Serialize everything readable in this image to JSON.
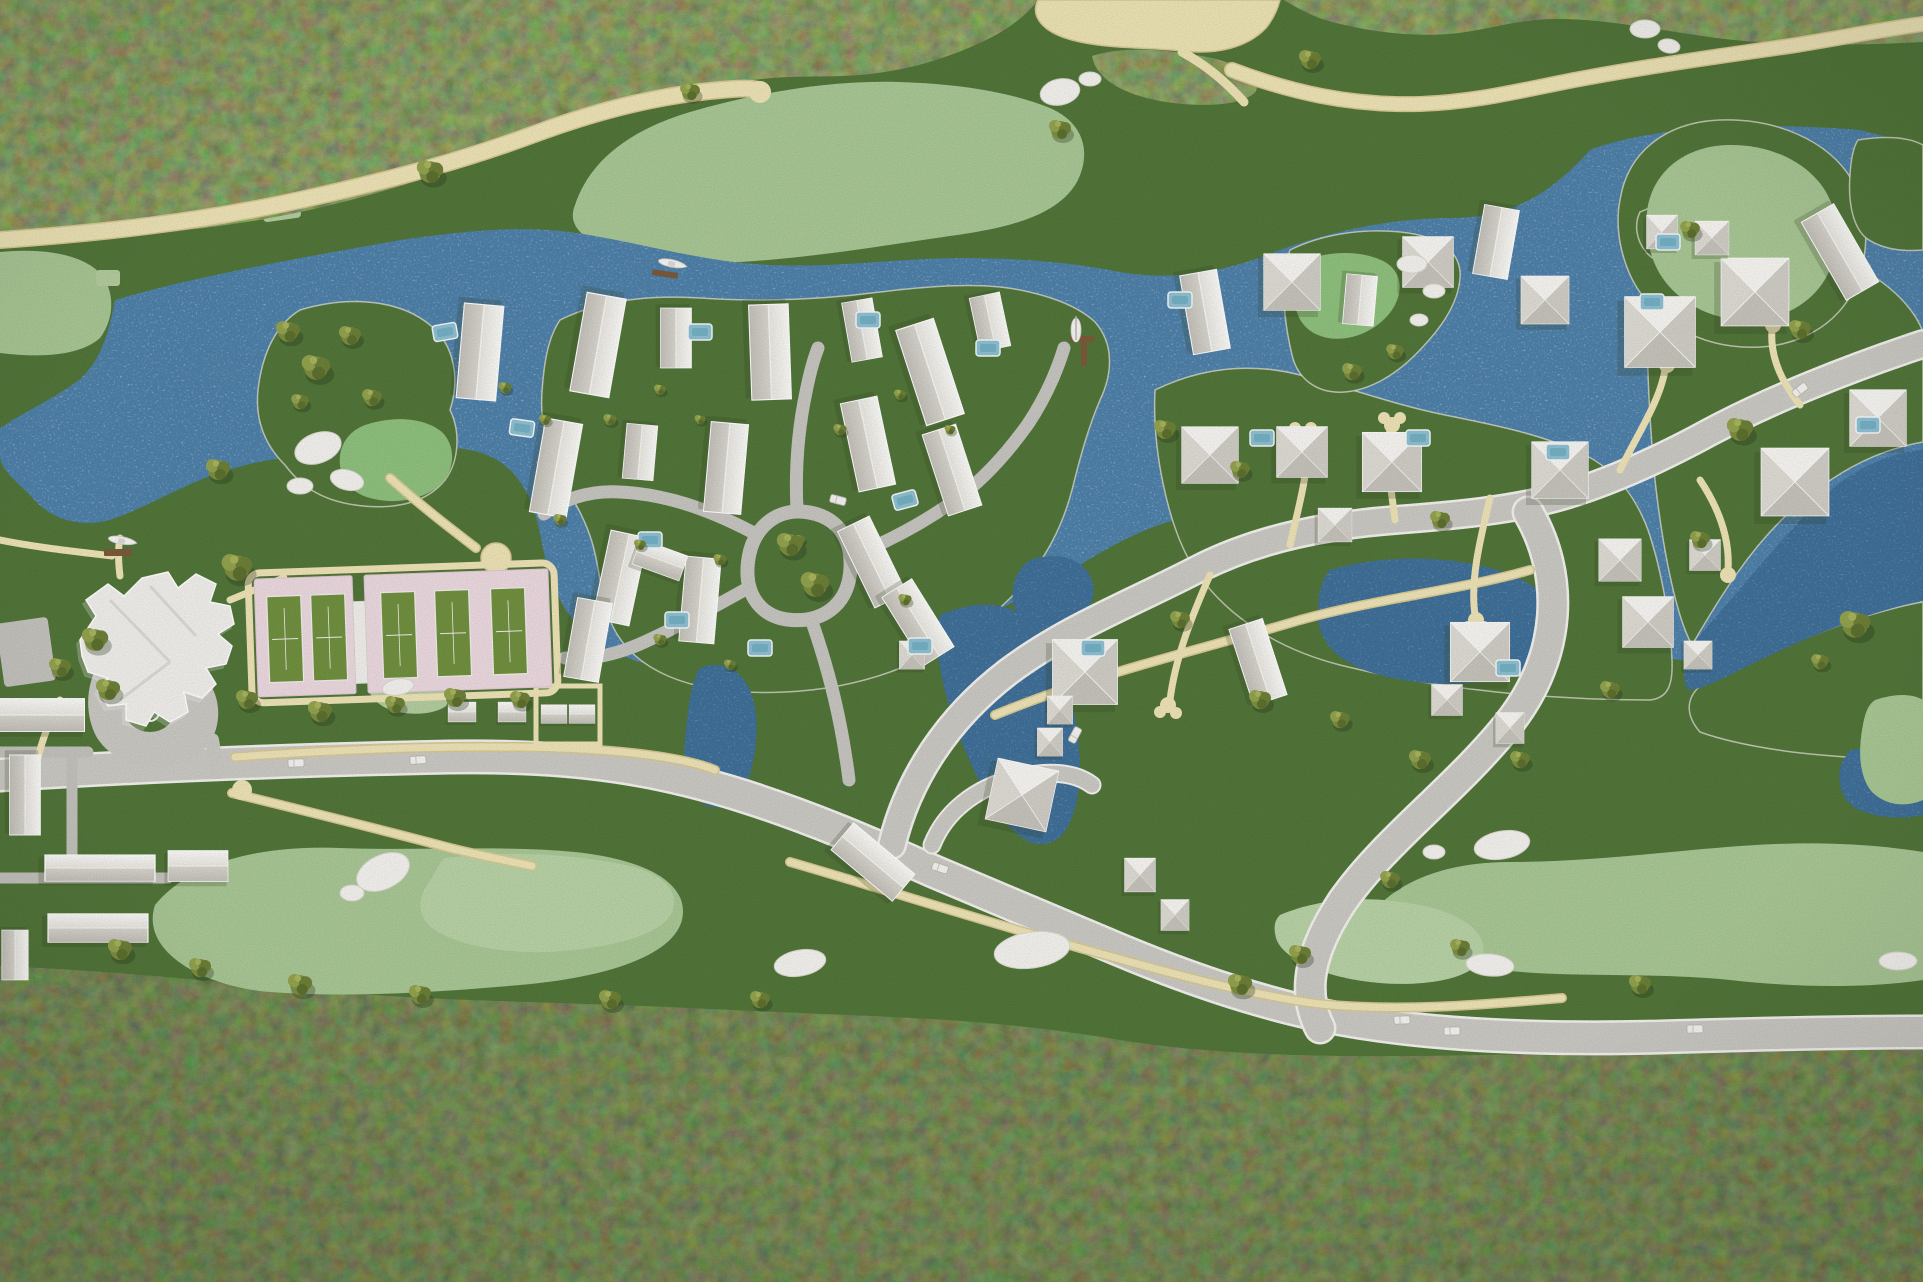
{
  "meta": {
    "title": "Aerial view of an architectural scale model of a waterfront golf resort community",
    "description": "Top-down photograph of a physical planning model: dark moss forest bands at top and bottom, a blue lagoon with white speckles winding through the middle, light-green golf fairways with white sand bunkers, cream cart paths, a gray main road, a white clubhouse with circular drive, pink tennis pads with green courts, clusters of small white model houses with pools, olive foliage clumps and two boats at docks."
  },
  "palette": {
    "forest_green": "#44582a",
    "rough_green": "#52763a",
    "fairway_green": "#a9c795",
    "putting_green": "#bad3a7",
    "water_blue": "#4e80a9",
    "water_deep": "#3f6f98",
    "path_cream": "#eee3b6",
    "path_edge": "#d8c993",
    "sand_cream": "#ece2b4",
    "road_gray": "#cbc9c4",
    "road_edge": "#f2f1ed",
    "lane_gray": "#c7c5c0",
    "house_white": "#f2f1ed",
    "roof_shade": "#c6c3bb",
    "tennis_pink": "#ecd9e0",
    "court_green": "#71903f",
    "pool_blue": "#8fc0d2",
    "tree_olive": "#7d8f41",
    "bunker_white": "#f3f2ee",
    "dock_brown": "#7b5a3a"
  },
  "scene": {
    "counts": {
      "houses": 56,
      "trees": 58,
      "pools": 19,
      "bunkers": 19,
      "cars": 9,
      "boats": 3,
      "tennis_courts": 5,
      "docks": 3
    },
    "tennis": {
      "court_w": 34,
      "court_h": 86,
      "courts": [
        [
          268,
          592
        ],
        [
          312,
          592
        ],
        [
          382,
          592
        ],
        [
          436,
          592
        ],
        [
          492,
          592
        ]
      ]
    },
    "houses": [
      [
        480,
        352,
        95,
        0.95,
        0.9,
        "g"
      ],
      [
        598,
        345,
        100,
        1.0,
        0.9,
        "g"
      ],
      [
        676,
        338,
        90,
        0.6,
        0.7,
        "g"
      ],
      [
        770,
        352,
        88,
        0.95,
        0.9,
        "g"
      ],
      [
        930,
        372,
        72,
        1.0,
        0.9,
        "g"
      ],
      [
        862,
        330,
        80,
        0.6,
        0.7,
        "g"
      ],
      [
        990,
        322,
        78,
        0.55,
        0.7,
        "g"
      ],
      [
        556,
        468,
        100,
        0.95,
        0.85,
        "g"
      ],
      [
        640,
        452,
        95,
        0.55,
        0.7,
        "g"
      ],
      [
        726,
        468,
        95,
        0.9,
        0.85,
        "g"
      ],
      [
        868,
        444,
        78,
        0.9,
        0.85,
        "g"
      ],
      [
        952,
        470,
        72,
        0.85,
        0.8,
        "g"
      ],
      [
        620,
        578,
        102,
        0.9,
        0.85,
        "g"
      ],
      [
        700,
        600,
        95,
        0.85,
        0.8,
        "g"
      ],
      [
        872,
        562,
        64,
        0.85,
        0.8,
        "g"
      ],
      [
        918,
        622,
        58,
        0.8,
        0.8,
        "g"
      ],
      [
        588,
        640,
        100,
        0.8,
        0.8,
        "g"
      ],
      [
        660,
        560,
        20,
        0.5,
        0.6,
        "g"
      ],
      [
        1205,
        312,
        80,
        0.8,
        0.85,
        "g"
      ],
      [
        1292,
        282,
        0,
        1.0,
        1.0,
        "h"
      ],
      [
        1360,
        300,
        95,
        0.5,
        0.7,
        "g"
      ],
      [
        1428,
        262,
        0,
        0.9,
        0.9,
        "h"
      ],
      [
        1496,
        242,
        100,
        0.7,
        0.8,
        "g"
      ],
      [
        1545,
        300,
        0,
        0.85,
        0.85,
        "h"
      ],
      [
        1210,
        455,
        0,
        1.0,
        1.0,
        "h"
      ],
      [
        1302,
        452,
        0,
        0.9,
        0.9,
        "h"
      ],
      [
        1392,
        462,
        0,
        1.05,
        1.05,
        "h"
      ],
      [
        1335,
        525,
        0,
        0.6,
        0.6,
        "h"
      ],
      [
        1560,
        470,
        0,
        1.0,
        1.0,
        "h"
      ],
      [
        1620,
        560,
        0,
        0.75,
        0.75,
        "h"
      ],
      [
        1480,
        652,
        0,
        1.05,
        1.05,
        "h"
      ],
      [
        1447,
        700,
        0,
        0.55,
        0.55,
        "h"
      ],
      [
        1510,
        728,
        0,
        0.5,
        0.55,
        "h"
      ],
      [
        1085,
        672,
        0,
        1.15,
        1.15,
        "h"
      ],
      [
        1060,
        710,
        0,
        0.45,
        0.5,
        "h"
      ],
      [
        1050,
        742,
        0,
        0.45,
        0.5,
        "h"
      ],
      [
        1022,
        795,
        12,
        1.1,
        1.1,
        "h"
      ],
      [
        912,
        655,
        0,
        0.45,
        0.5,
        "h"
      ],
      [
        1140,
        875,
        0,
        0.55,
        0.6,
        "h"
      ],
      [
        1175,
        915,
        0,
        0.5,
        0.55,
        "h"
      ],
      [
        873,
        862,
        40,
        0.8,
        0.8,
        "g"
      ],
      [
        1258,
        662,
        72,
        0.8,
        0.8,
        "g"
      ],
      [
        1660,
        332,
        0,
        1.25,
        1.25,
        "h"
      ],
      [
        1755,
        292,
        0,
        1.2,
        1.2,
        "h"
      ],
      [
        1712,
        238,
        0,
        0.6,
        0.6,
        "h"
      ],
      [
        1840,
        252,
        60,
        0.9,
        0.85,
        "g"
      ],
      [
        1878,
        418,
        0,
        1.0,
        1.0,
        "h"
      ],
      [
        1795,
        482,
        0,
        1.2,
        1.2,
        "h"
      ],
      [
        1705,
        555,
        0,
        0.55,
        0.55,
        "h"
      ],
      [
        1648,
        622,
        0,
        0.9,
        0.9,
        "h"
      ],
      [
        1698,
        655,
        0,
        0.5,
        0.5,
        "h"
      ],
      [
        1662,
        232,
        0,
        0.55,
        0.6,
        "h"
      ],
      [
        42,
        715,
        0,
        0.85,
        0.75,
        "g"
      ],
      [
        25,
        795,
        90,
        0.8,
        0.7,
        "g"
      ],
      [
        100,
        868,
        0,
        1.1,
        0.6,
        "g"
      ],
      [
        198,
        866,
        0,
        0.6,
        0.7,
        "g"
      ],
      [
        98,
        928,
        0,
        1.0,
        0.65,
        "g"
      ],
      [
        15,
        955,
        90,
        0.5,
        0.6,
        "g"
      ],
      [
        462,
        712,
        0,
        0.28,
        0.45,
        "g"
      ],
      [
        512,
        712,
        0,
        0.28,
        0.45,
        "g"
      ],
      [
        554,
        714,
        0,
        0.26,
        0.42,
        "g"
      ],
      [
        582,
        714,
        0,
        0.26,
        0.42,
        "g"
      ]
    ],
    "pools": [
      [
        650,
        540,
        0
      ],
      [
        677,
        620,
        0
      ],
      [
        445,
        332,
        -10
      ],
      [
        522,
        428,
        8
      ],
      [
        700,
        332,
        0
      ],
      [
        868,
        320,
        0
      ],
      [
        988,
        348,
        0
      ],
      [
        905,
        500,
        -15
      ],
      [
        920,
        646,
        0
      ],
      [
        1093,
        648,
        0
      ],
      [
        760,
        648,
        0
      ],
      [
        1180,
        300,
        0
      ],
      [
        1262,
        438,
        0
      ],
      [
        1418,
        438,
        0
      ],
      [
        1558,
        452,
        0
      ],
      [
        1652,
        302,
        0
      ],
      [
        1508,
        668,
        0
      ],
      [
        1668,
        242,
        0
      ],
      [
        1868,
        425,
        0
      ]
    ],
    "trees": [
      [
        288,
        332,
        1.1
      ],
      [
        316,
        368,
        1.3
      ],
      [
        350,
        336,
        1.0
      ],
      [
        372,
        398,
        0.9
      ],
      [
        300,
        402,
        0.8
      ],
      [
        95,
        640,
        1.2
      ],
      [
        60,
        668,
        1.0
      ],
      [
        108,
        690,
        1.1
      ],
      [
        237,
        568,
        1.4
      ],
      [
        247,
        700,
        1.0
      ],
      [
        320,
        712,
        1.1
      ],
      [
        395,
        705,
        0.9
      ],
      [
        455,
        698,
        1.0
      ],
      [
        520,
        700,
        0.9
      ],
      [
        218,
        470,
        1.1
      ],
      [
        505,
        388,
        0.6
      ],
      [
        545,
        420,
        0.55
      ],
      [
        610,
        420,
        0.6
      ],
      [
        660,
        390,
        0.55
      ],
      [
        700,
        420,
        0.5
      ],
      [
        560,
        520,
        0.6
      ],
      [
        640,
        545,
        0.55
      ],
      [
        720,
        560,
        0.6
      ],
      [
        800,
        540,
        0.5
      ],
      [
        840,
        430,
        0.6
      ],
      [
        900,
        395,
        0.55
      ],
      [
        950,
        430,
        0.5
      ],
      [
        660,
        640,
        0.6
      ],
      [
        730,
        665,
        0.55
      ],
      [
        905,
        600,
        0.6
      ],
      [
        790,
        545,
        1.2
      ],
      [
        815,
        585,
        1.3
      ],
      [
        430,
        172,
        1.2
      ],
      [
        690,
        92,
        0.9
      ],
      [
        1310,
        60,
        1.0
      ],
      [
        1352,
        372,
        0.9
      ],
      [
        1395,
        352,
        0.8
      ],
      [
        1165,
        430,
        1.0
      ],
      [
        1240,
        470,
        0.9
      ],
      [
        1440,
        520,
        0.9
      ],
      [
        1180,
        620,
        0.9
      ],
      [
        1260,
        700,
        1.0
      ],
      [
        1340,
        720,
        0.9
      ],
      [
        1420,
        760,
        1.0
      ],
      [
        1520,
        760,
        0.9
      ],
      [
        1610,
        690,
        0.9
      ],
      [
        1700,
        540,
        0.9
      ],
      [
        1740,
        430,
        1.2
      ],
      [
        1800,
        330,
        1.0
      ],
      [
        1690,
        230,
        0.9
      ],
      [
        1855,
        625,
        1.4
      ],
      [
        1820,
        662,
        0.8
      ],
      [
        120,
        950,
        1.1
      ],
      [
        200,
        968,
        1.0
      ],
      [
        300,
        985,
        1.1
      ],
      [
        420,
        995,
        1.0
      ],
      [
        610,
        1000,
        1.0
      ],
      [
        760,
        1000,
        0.9
      ],
      [
        1240,
        985,
        1.1
      ],
      [
        1300,
        955,
        1.0
      ],
      [
        1460,
        948,
        0.9
      ],
      [
        1640,
        985,
        1.0
      ],
      [
        1390,
        880,
        0.9
      ],
      [
        1060,
        130,
        1.0
      ]
    ],
    "bunkers": [
      [
        318,
        448,
        24,
        15,
        -20
      ],
      [
        300,
        486,
        13,
        8,
        0
      ],
      [
        347,
        480,
        17,
        10,
        15
      ],
      [
        398,
        687,
        16,
        8,
        -10
      ],
      [
        383,
        872,
        28,
        17,
        -25
      ],
      [
        352,
        893,
        12,
        8,
        0
      ],
      [
        800,
        963,
        26,
        13,
        -10
      ],
      [
        1032,
        950,
        38,
        18,
        -8
      ],
      [
        1645,
        29,
        15,
        9,
        0
      ],
      [
        1669,
        46,
        11,
        7,
        10
      ],
      [
        1060,
        92,
        20,
        13,
        -12
      ],
      [
        1090,
        79,
        11,
        7,
        0
      ],
      [
        1412,
        264,
        15,
        9,
        0
      ],
      [
        1434,
        291,
        11,
        7,
        0
      ],
      [
        1419,
        320,
        9,
        6,
        0
      ],
      [
        1502,
        845,
        28,
        14,
        -10
      ],
      [
        1434,
        852,
        11,
        7,
        0
      ],
      [
        1490,
        965,
        24,
        11,
        5
      ],
      [
        1898,
        961,
        19,
        9,
        0
      ]
    ],
    "cars": [
      [
        296,
        763,
        -2
      ],
      [
        418,
        760,
        -3
      ],
      [
        940,
        868,
        18
      ],
      [
        1075,
        735,
        -62
      ],
      [
        1402,
        1020,
        -2
      ],
      [
        1452,
        1031,
        -1
      ],
      [
        1695,
        1029,
        -1
      ],
      [
        1800,
        390,
        -38
      ],
      [
        838,
        500,
        15
      ]
    ],
    "boats": [
      {
        "kind": "motorboat",
        "x": 672,
        "y": 264,
        "rot": 14
      },
      {
        "kind": "sailboat",
        "x": 1076,
        "y": 330,
        "rot": 0
      },
      {
        "kind": "motorboat",
        "x": 122,
        "y": 541,
        "rot": 12
      }
    ]
  }
}
